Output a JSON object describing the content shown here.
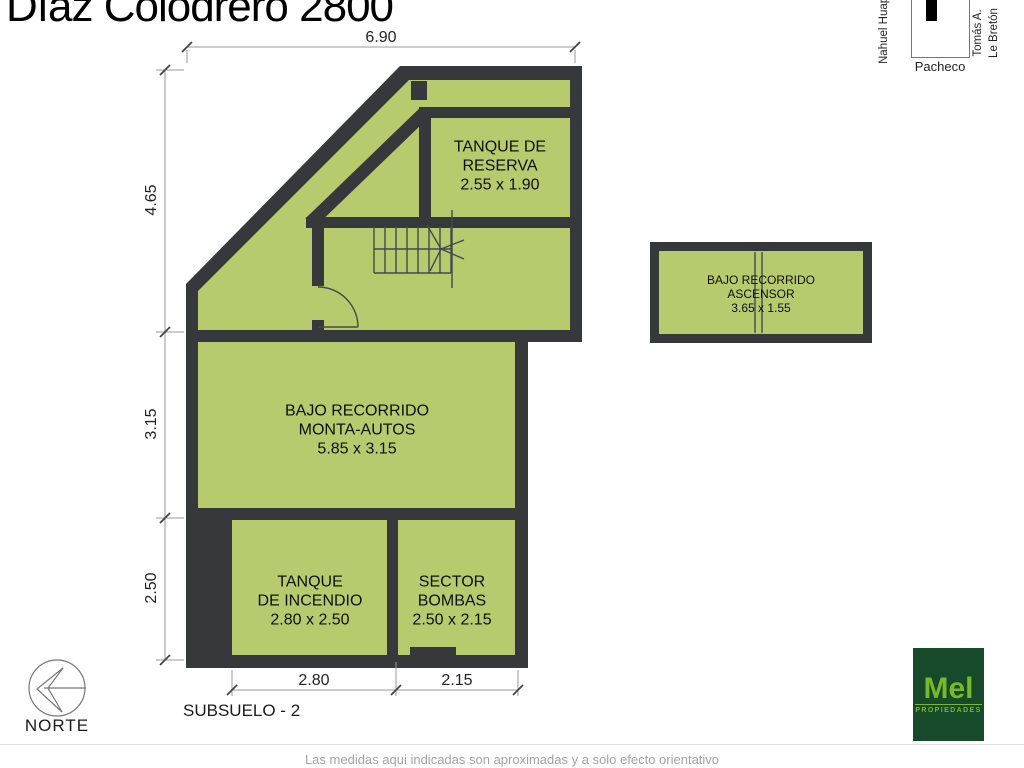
{
  "title": "Díaz Colodrero 2800",
  "floor_label": "SUBSUELO - 2",
  "compass_label": "NORTE",
  "disclaimer": "Las medidas aqui indicadas son aproximadas y a solo efecto orientativo",
  "map": {
    "street_left": "Nahuel Huap",
    "street_right_1": "Tomás A.",
    "street_right_2": "Le Bretón",
    "street_bottom": "Pacheco"
  },
  "logo": {
    "name": "Mel",
    "subtitle": "PROPIEDADES"
  },
  "rooms": {
    "reserva": {
      "l1": "TANQUE DE",
      "l2": "RESERVA",
      "size": "2.55 x 1.90"
    },
    "ascensor": {
      "l1": "BAJO RECORRIDO",
      "l2": "ASCENSOR",
      "size": "3.65 x 1.55"
    },
    "monta_autos": {
      "l1": "BAJO RECORRIDO",
      "l2": "MONTA-AUTOS",
      "size": "5.85 x 3.15"
    },
    "incendio": {
      "l1": "TANQUE",
      "l2": "DE INCENDIO",
      "size": "2.80 x 2.50"
    },
    "bombas": {
      "l1": "SECTOR",
      "l2": "BOMBAS",
      "size": "2.50 x 2.15"
    }
  },
  "dims": {
    "top": "6.90",
    "left_a": "4.65",
    "left_b": "3.15",
    "left_c": "2.50",
    "bottom_a": "2.80",
    "bottom_b": "2.15"
  },
  "colors": {
    "wall": "#35393c",
    "room": "#b5cb6e",
    "thin": "#45494c",
    "dim": "#9a9a9a",
    "mel_bg": "#174a2b",
    "mel_green": "#79b829"
  }
}
